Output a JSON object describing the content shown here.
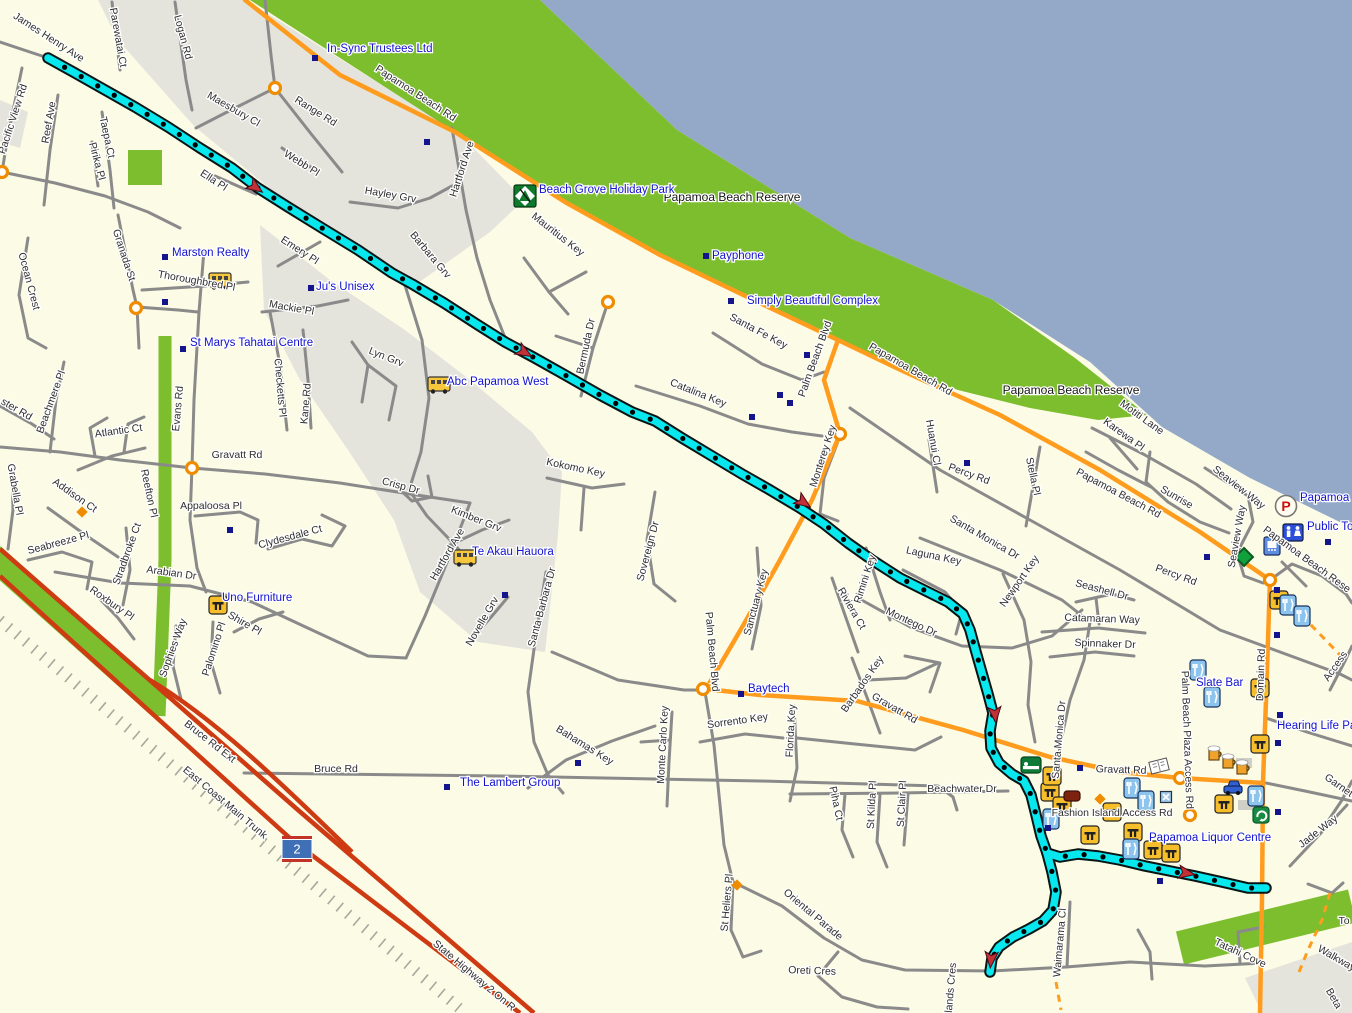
{
  "map": {
    "colors": {
      "land": "#FBFBE6",
      "urban": "#E4E4DC",
      "water": "#94A8C8",
      "reserve_green": "#7DBE2E",
      "road_minor": "#8A8A8A",
      "road_major": "#FF9C1E",
      "highway_red": "#CE3A12",
      "railway": "#A8A89E",
      "track": "#06E7EE",
      "track_casing": "#0A1414",
      "poi_text": "#1212CE",
      "street_text": "#2E2E2E",
      "poi_dot": "#14148C",
      "arrow": "#C23038",
      "roundabout": "#F08C00"
    },
    "highway_shield": {
      "label": "2",
      "x": 297,
      "y": 849
    },
    "street_labels": [
      {
        "t": "James Henry Ave",
        "x": 47,
        "y": 40,
        "r": 33
      },
      {
        "t": "Pacific View Rd",
        "x": 16,
        "y": 120,
        "r": -72
      },
      {
        "t": "Reef Ave",
        "x": 52,
        "y": 123,
        "r": -80
      },
      {
        "t": "Parewatai Ct",
        "x": 115,
        "y": 38,
        "r": 80
      },
      {
        "t": "Logan Rd",
        "x": 180,
        "y": 38,
        "r": 75
      },
      {
        "t": "Maesbury Cl",
        "x": 232,
        "y": 112,
        "r": 30
      },
      {
        "t": "Range Rd",
        "x": 314,
        "y": 114,
        "r": 32
      },
      {
        "t": "Webb Pl",
        "x": 300,
        "y": 166,
        "r": 32
      },
      {
        "t": "Hayley Grv",
        "x": 390,
        "y": 198,
        "r": 10
      },
      {
        "t": "Hartford Ave",
        "x": 465,
        "y": 170,
        "r": -72
      },
      {
        "t": "Taepa Ct",
        "x": 104,
        "y": 138,
        "r": 78
      },
      {
        "t": "Pirika Pl",
        "x": 94,
        "y": 162,
        "r": 75
      },
      {
        "t": "Granada St",
        "x": 121,
        "y": 256,
        "r": 72
      },
      {
        "t": "Ocean Crest",
        "x": 26,
        "y": 282,
        "r": 75
      },
      {
        "t": "Thoroughbred Pl",
        "x": 196,
        "y": 284,
        "r": 10
      },
      {
        "t": "Ella Pl",
        "x": 212,
        "y": 183,
        "r": 33
      },
      {
        "t": "Emery Pl",
        "x": 298,
        "y": 253,
        "r": 33
      },
      {
        "t": "Mackie Pl",
        "x": 291,
        "y": 311,
        "r": 10
      },
      {
        "t": "Barbara Grv",
        "x": 428,
        "y": 257,
        "r": 50
      },
      {
        "t": "Evans Rd",
        "x": 181,
        "y": 409,
        "r": -85
      },
      {
        "t": "Checketts Pl",
        "x": 277,
        "y": 388,
        "r": 85
      },
      {
        "t": "Kane Rd",
        "x": 309,
        "y": 404,
        "r": -85
      },
      {
        "t": "Lyn Grv",
        "x": 385,
        "y": 360,
        "r": 22
      },
      {
        "t": "Mauritius Key",
        "x": 556,
        "y": 237,
        "r": 38
      },
      {
        "t": "Bermuda Dr",
        "x": 589,
        "y": 347,
        "r": -78
      },
      {
        "t": "Papamoa Beach Rd",
        "x": 414,
        "y": 96,
        "r": 33
      },
      {
        "t": "Papamoa Beach Rd",
        "x": 909,
        "y": 372,
        "r": 30
      },
      {
        "t": "Papamoa Beach Rd",
        "x": 1117,
        "y": 496,
        "r": 28
      },
      {
        "t": "Santa Fe Key",
        "x": 757,
        "y": 334,
        "r": 28
      },
      {
        "t": "Palm Beach Blvd",
        "x": 818,
        "y": 360,
        "r": -70
      },
      {
        "t": "Catalina Key",
        "x": 697,
        "y": 396,
        "r": 22
      },
      {
        "t": "Monterey Key",
        "x": 826,
        "y": 457,
        "r": -72
      },
      {
        "t": "Huanui Cl",
        "x": 930,
        "y": 443,
        "r": 80
      },
      {
        "t": "Percy Rd",
        "x": 968,
        "y": 477,
        "r": 20
      },
      {
        "t": "Stella Pl",
        "x": 1030,
        "y": 477,
        "r": 78
      },
      {
        "t": "Motiti Lane",
        "x": 1140,
        "y": 420,
        "r": 36
      },
      {
        "t": "Karewa Pl",
        "x": 1122,
        "y": 437,
        "r": 36
      },
      {
        "t": "Sunrise",
        "x": 1175,
        "y": 500,
        "r": 30
      },
      {
        "t": "Seaview Way",
        "x": 1237,
        "y": 490,
        "r": 38
      },
      {
        "t": "Seaview Way",
        "x": 1240,
        "y": 537,
        "r": -80
      },
      {
        "t": "Percy Rd",
        "x": 1175,
        "y": 578,
        "r": 20
      },
      {
        "t": "Santa Monica Dr",
        "x": 983,
        "y": 540,
        "r": 30
      },
      {
        "t": "Rimini Key",
        "x": 868,
        "y": 580,
        "r": -72
      },
      {
        "t": "Laguna Key",
        "x": 933,
        "y": 559,
        "r": 12
      },
      {
        "t": "Newport Key",
        "x": 1022,
        "y": 583,
        "r": -55
      },
      {
        "t": "Seashell Dr",
        "x": 1101,
        "y": 593,
        "r": 15
      },
      {
        "t": "Catamaran Way",
        "x": 1102,
        "y": 622,
        "r": 2
      },
      {
        "t": "Spinnaker Dr",
        "x": 1105,
        "y": 647,
        "r": 2
      },
      {
        "t": "Riviera Ct",
        "x": 849,
        "y": 610,
        "r": 60
      },
      {
        "t": "Montego Dr",
        "x": 910,
        "y": 625,
        "r": 25
      },
      {
        "t": "Barbados Key",
        "x": 865,
        "y": 686,
        "r": -55
      },
      {
        "t": "Gravatt Rd",
        "x": 893,
        "y": 711,
        "r": 30
      },
      {
        "t": "Gravatt Rd",
        "x": 1121,
        "y": 773,
        "r": 2
      },
      {
        "t": "Gravatt Rd",
        "x": 237,
        "y": 458,
        "r": 0
      },
      {
        "t": "Crisp Dr",
        "x": 400,
        "y": 489,
        "r": 15
      },
      {
        "t": "Kimber Grv",
        "x": 475,
        "y": 522,
        "r": 22
      },
      {
        "t": "Kokomo Key",
        "x": 575,
        "y": 471,
        "r": 12
      },
      {
        "t": "Hartford Ave",
        "x": 450,
        "y": 556,
        "r": -60
      },
      {
        "t": "Novelle Grv",
        "x": 485,
        "y": 623,
        "r": -60
      },
      {
        "t": "Santa Barbara Dr",
        "x": 545,
        "y": 608,
        "r": -75
      },
      {
        "t": "Sovereign Dr",
        "x": 651,
        "y": 552,
        "r": -75
      },
      {
        "t": "Sanctuary Key",
        "x": 759,
        "y": 603,
        "r": -75
      },
      {
        "t": "Palm Beach Blvd",
        "x": 709,
        "y": 652,
        "r": 85
      },
      {
        "t": "Monte Carlo Key",
        "x": 666,
        "y": 745,
        "r": -87
      },
      {
        "t": "Sorrento Key",
        "x": 738,
        "y": 724,
        "r": -8
      },
      {
        "t": "Florida Key",
        "x": 794,
        "y": 731,
        "r": -87
      },
      {
        "t": "Bahamas Key",
        "x": 583,
        "y": 748,
        "r": 32
      },
      {
        "t": "Piha Ct",
        "x": 833,
        "y": 804,
        "r": 78
      },
      {
        "t": "St Kilda Pl",
        "x": 875,
        "y": 805,
        "r": -87
      },
      {
        "t": "St Clair Pl",
        "x": 905,
        "y": 804,
        "r": -87
      },
      {
        "t": "Beachwater Dr",
        "x": 962,
        "y": 792,
        "r": 0
      },
      {
        "t": "Santa Monica Dr",
        "x": 1062,
        "y": 740,
        "r": -85
      },
      {
        "t": "Oriental Parade",
        "x": 811,
        "y": 917,
        "r": 40
      },
      {
        "t": "St Heliers Pl",
        "x": 730,
        "y": 903,
        "r": -85
      },
      {
        "t": "Oreti Cres",
        "x": 812,
        "y": 974,
        "r": 2
      },
      {
        "t": "lands Cres",
        "x": 954,
        "y": 988,
        "r": -85
      },
      {
        "t": "Waimarama Cl",
        "x": 1063,
        "y": 943,
        "r": -85
      },
      {
        "t": "Tatahi Cove",
        "x": 1239,
        "y": 956,
        "r": 25
      },
      {
        "t": "Walkway",
        "x": 1335,
        "y": 961,
        "r": 30
      },
      {
        "t": "Beta",
        "x": 1331,
        "y": 1000,
        "r": 60
      },
      {
        "t": "To",
        "x": 1344,
        "y": 924,
        "r": 0
      },
      {
        "t": "ster Rd",
        "x": 15,
        "y": 412,
        "r": 30
      },
      {
        "t": "Beachmere Pl",
        "x": 54,
        "y": 403,
        "r": -70
      },
      {
        "t": "Atlantic Ct",
        "x": 119,
        "y": 434,
        "r": -8
      },
      {
        "t": "Addison Ct",
        "x": 73,
        "y": 498,
        "r": 35
      },
      {
        "t": "Reefton Pl",
        "x": 146,
        "y": 494,
        "r": 78
      },
      {
        "t": "Grabella Pl",
        "x": 12,
        "y": 490,
        "r": 80
      },
      {
        "t": "Seabreeze Pl",
        "x": 59,
        "y": 546,
        "r": -15
      },
      {
        "t": "Stradbroke Ct",
        "x": 130,
        "y": 555,
        "r": -70
      },
      {
        "t": "Arabian Dr",
        "x": 171,
        "y": 576,
        "r": 8
      },
      {
        "t": "Roxbury Pl",
        "x": 110,
        "y": 606,
        "r": 35
      },
      {
        "t": "Appaloosa Pl",
        "x": 211,
        "y": 509,
        "r": 0
      },
      {
        "t": "Clydesdale Ct",
        "x": 291,
        "y": 540,
        "r": -15
      },
      {
        "t": "Sophies Way",
        "x": 176,
        "y": 649,
        "r": -70
      },
      {
        "t": "Palomino Pl",
        "x": 217,
        "y": 650,
        "r": -72
      },
      {
        "t": "Shire Pl",
        "x": 243,
        "y": 626,
        "r": 30
      },
      {
        "t": "Bruce Rd Ext",
        "x": 208,
        "y": 744,
        "r": 38
      },
      {
        "t": "Bruce Rd",
        "x": 336,
        "y": 772,
        "r": 0
      },
      {
        "t": "East Coast Main Trunk",
        "x": 223,
        "y": 805,
        "r": 40
      },
      {
        "t": "State Highway 2 On R",
        "x": 472,
        "y": 978,
        "r": 40
      },
      {
        "t": "Domain Rd",
        "x": 1264,
        "y": 675,
        "r": -88
      },
      {
        "t": "Palm Beach Plaza Access Rd",
        "x": 1184,
        "y": 740,
        "r": 88
      },
      {
        "t": "Fashion Island Access Rd",
        "x": 1112,
        "y": 816,
        "r": 0
      },
      {
        "t": "Access",
        "x": 1338,
        "y": 668,
        "r": -55
      },
      {
        "t": "Garnet",
        "x": 1337,
        "y": 788,
        "r": 35
      },
      {
        "t": "Jade Way",
        "x": 1320,
        "y": 834,
        "r": -38
      },
      {
        "t": "Papamoa Beach Rese",
        "x": 1305,
        "y": 562,
        "r": 36
      }
    ],
    "area_labels": [
      {
        "t": "Papamoa Beach Reserve",
        "x": 732,
        "y": 201
      },
      {
        "t": "Papamoa Beach Reserve",
        "x": 1071,
        "y": 394
      }
    ],
    "poi_labels": [
      {
        "t": "In-Sync Trustees Ltd",
        "x": 327,
        "y": 52
      },
      {
        "t": "Beach Grove Holiday Park",
        "x": 539,
        "y": 193
      },
      {
        "t": "Payphone",
        "x": 712,
        "y": 259
      },
      {
        "t": "Simply Beautiful Complex",
        "x": 747,
        "y": 304
      },
      {
        "t": "Marston Realty",
        "x": 172,
        "y": 256
      },
      {
        "t": "Ju's Unisex",
        "x": 316,
        "y": 290
      },
      {
        "t": "St Marys Tahatai Centre",
        "x": 190,
        "y": 346
      },
      {
        "t": "Abc Papamoa West",
        "x": 447,
        "y": 385
      },
      {
        "t": "Te Akau Hauora",
        "x": 472,
        "y": 555
      },
      {
        "t": "Uno Furniture",
        "x": 222,
        "y": 601
      },
      {
        "t": "The Lambert Group",
        "x": 460,
        "y": 786
      },
      {
        "t": "Baytech",
        "x": 748,
        "y": 692
      },
      {
        "t": "Slate Bar",
        "x": 1196,
        "y": 686
      },
      {
        "t": "Hearing Life Pap",
        "x": 1277,
        "y": 729
      },
      {
        "t": "Papamoa Liquor Centre",
        "x": 1149,
        "y": 841
      },
      {
        "t": "Public Toi",
        "x": 1307,
        "y": 530
      },
      {
        "t": "Papamoa B",
        "x": 1300,
        "y": 501
      }
    ],
    "icons": [
      {
        "k": "bus",
        "x": 220,
        "y": 281
      },
      {
        "k": "bus",
        "x": 439,
        "y": 385
      },
      {
        "k": "bus",
        "x": 465,
        "y": 558
      },
      {
        "k": "camp",
        "x": 525,
        "y": 196
      },
      {
        "k": "campd",
        "x": 1244,
        "y": 557
      },
      {
        "k": "parking",
        "x": 1286,
        "y": 506
      },
      {
        "k": "toilet",
        "x": 1293,
        "y": 532
      },
      {
        "k": "shower",
        "x": 1272,
        "y": 546
      },
      {
        "k": "bench",
        "x": 218,
        "y": 605
      },
      {
        "k": "bench",
        "x": 1050,
        "y": 792
      },
      {
        "k": "bench",
        "x": 1062,
        "y": 806
      },
      {
        "k": "bench",
        "x": 1090,
        "y": 835
      },
      {
        "k": "bench",
        "x": 1112,
        "y": 812
      },
      {
        "k": "bench",
        "x": 1133,
        "y": 832
      },
      {
        "k": "bench",
        "x": 1153,
        "y": 850
      },
      {
        "k": "bench",
        "x": 1171,
        "y": 853
      },
      {
        "k": "bench",
        "x": 1224,
        "y": 804
      },
      {
        "k": "bench",
        "x": 1260,
        "y": 744
      },
      {
        "k": "bench",
        "x": 1260,
        "y": 688
      },
      {
        "k": "bench",
        "x": 1279,
        "y": 600
      },
      {
        "k": "bench",
        "x": 1052,
        "y": 776
      },
      {
        "k": "fork",
        "x": 1198,
        "y": 670
      },
      {
        "k": "fork",
        "x": 1212,
        "y": 697
      },
      {
        "k": "fork",
        "x": 1132,
        "y": 788
      },
      {
        "k": "fork",
        "x": 1146,
        "y": 801
      },
      {
        "k": "fork",
        "x": 1051,
        "y": 819
      },
      {
        "k": "fork",
        "x": 1131,
        "y": 849
      },
      {
        "k": "fork",
        "x": 1256,
        "y": 796
      },
      {
        "k": "fork",
        "x": 1288,
        "y": 605
      },
      {
        "k": "fork",
        "x": 1302,
        "y": 616
      },
      {
        "k": "beer",
        "x": 1214,
        "y": 754
      },
      {
        "k": "beer",
        "x": 1228,
        "y": 762
      },
      {
        "k": "beer",
        "x": 1242,
        "y": 768
      },
      {
        "k": "lodging",
        "x": 1031,
        "y": 765
      },
      {
        "k": "book",
        "x": 1159,
        "y": 766
      },
      {
        "k": "car",
        "x": 1233,
        "y": 789
      },
      {
        "k": "suv",
        "x": 1072,
        "y": 796
      },
      {
        "k": "recycle",
        "x": 1261,
        "y": 815
      },
      {
        "k": "xicon",
        "x": 1166,
        "y": 797
      }
    ],
    "poi_dots": [
      [
        315,
        58
      ],
      [
        427,
        142
      ],
      [
        165,
        257
      ],
      [
        165,
        302
      ],
      [
        311,
        288
      ],
      [
        183,
        349
      ],
      [
        706,
        256
      ],
      [
        731,
        301
      ],
      [
        807,
        355
      ],
      [
        780,
        395
      ],
      [
        790,
        403
      ],
      [
        752,
        417
      ],
      [
        967,
        463
      ],
      [
        505,
        595
      ],
      [
        578,
        763
      ],
      [
        741,
        694
      ],
      [
        447,
        787
      ],
      [
        230,
        530
      ],
      [
        1048,
        828
      ],
      [
        1207,
        557
      ],
      [
        1328,
        542
      ],
      [
        1277,
        590
      ],
      [
        1277,
        635
      ],
      [
        1280,
        715
      ],
      [
        1278,
        743
      ],
      [
        1278,
        812
      ],
      [
        1160,
        881
      ],
      [
        1080,
        768
      ]
    ],
    "roundabouts": [
      [
        275,
        88
      ],
      [
        2,
        172
      ],
      [
        136,
        308
      ],
      [
        192,
        468
      ],
      [
        608,
        302
      ],
      [
        703,
        689
      ],
      [
        840,
        434
      ],
      [
        1270,
        580
      ],
      [
        1180,
        778
      ],
      [
        1190,
        815
      ]
    ],
    "mini_junctions": [
      [
        82,
        512
      ],
      [
        737,
        885
      ],
      [
        1100,
        799
      ]
    ],
    "track_arrows": [
      {
        "x": 255,
        "y": 187,
        "r": 125
      },
      {
        "x": 524,
        "y": 352,
        "r": 120
      },
      {
        "x": 803,
        "y": 502,
        "r": 125
      },
      {
        "x": 995,
        "y": 714,
        "r": 175
      },
      {
        "x": 1186,
        "y": 873,
        "r": 100
      },
      {
        "x": 991,
        "y": 959,
        "r": 185
      }
    ]
  }
}
